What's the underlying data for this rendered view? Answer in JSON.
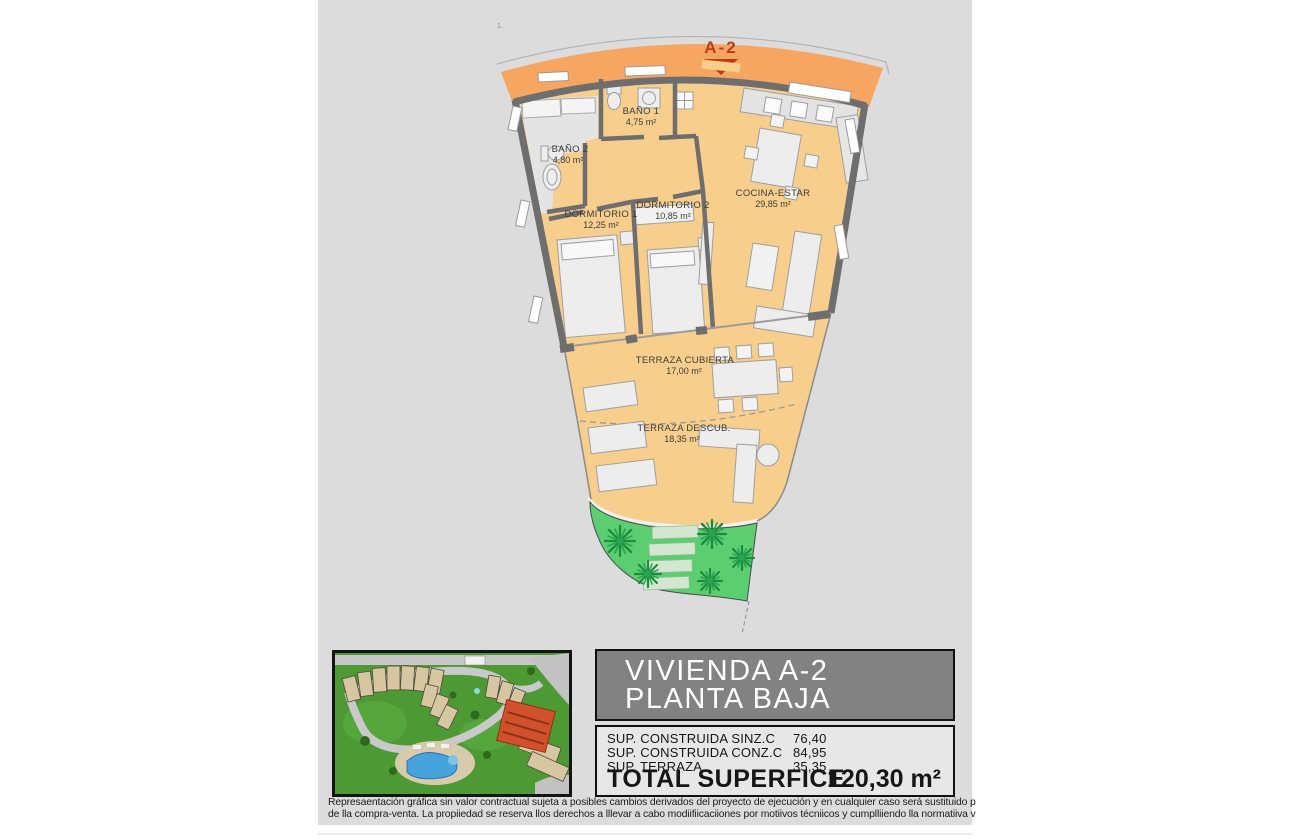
{
  "plan": {
    "corner_mark": "1.",
    "unit_marker": "A-2",
    "rooms": [
      {
        "id": "banio1",
        "name": "BAÑO 1",
        "area": "4,75 m²"
      },
      {
        "id": "banio2",
        "name": "BAÑO 2",
        "area": "4,80 m²"
      },
      {
        "id": "dormitorio1",
        "name": "DORMITORIO 1",
        "area": "12,25 m²"
      },
      {
        "id": "dormitorio2",
        "name": "DORMITORIO 2",
        "area": "10,85 m²"
      },
      {
        "id": "cocina-estar",
        "name": "COCINA-ESTAR",
        "area": "29,85 m²"
      },
      {
        "id": "terraza-cubierta",
        "name": "TERRAZA CUBIERTA",
        "area": "17,00 m²"
      },
      {
        "id": "terraza-descubierta",
        "name": "TERRAZA DESCUB.",
        "area": "18,35 m²"
      }
    ],
    "colors": {
      "access_band": "#F7A661",
      "floor": "#F7CE8C",
      "wall": "#6E6E6E",
      "marker_red": "#BE3A1A",
      "garden_green": "#5BCE72",
      "page_gray": "#DCDCDC"
    }
  },
  "info": {
    "title_line1": "VIVIENDA A-2",
    "title_line2": "PLANTA BAJA",
    "surfaces": [
      {
        "label": "SUP. CONSTRUIDA SINZ.C",
        "value": "76,40"
      },
      {
        "label": "SUP. CONSTRUIDA CONZ.C",
        "value": "84,95"
      },
      {
        "label": "SUP. TERRAZA",
        "value": "35,35"
      }
    ],
    "total_label": "TOTAL SUPERFICE",
    "total_value": "120,30 m²"
  },
  "disclaimer": {
    "line1": "Represaentación gráfica sin valor contractual sujeta a posibles cambios derivados del proyecto de ejecución y en cualquier caso será sustituido por el definitivo en",
    "line2": "de lla compra-venta. La propiiedad se reserva llos derechos a lllevar a cabo modiifiicaciiones por motiivos técniicos y cumplliiendo lla normatiiva viigente."
  }
}
